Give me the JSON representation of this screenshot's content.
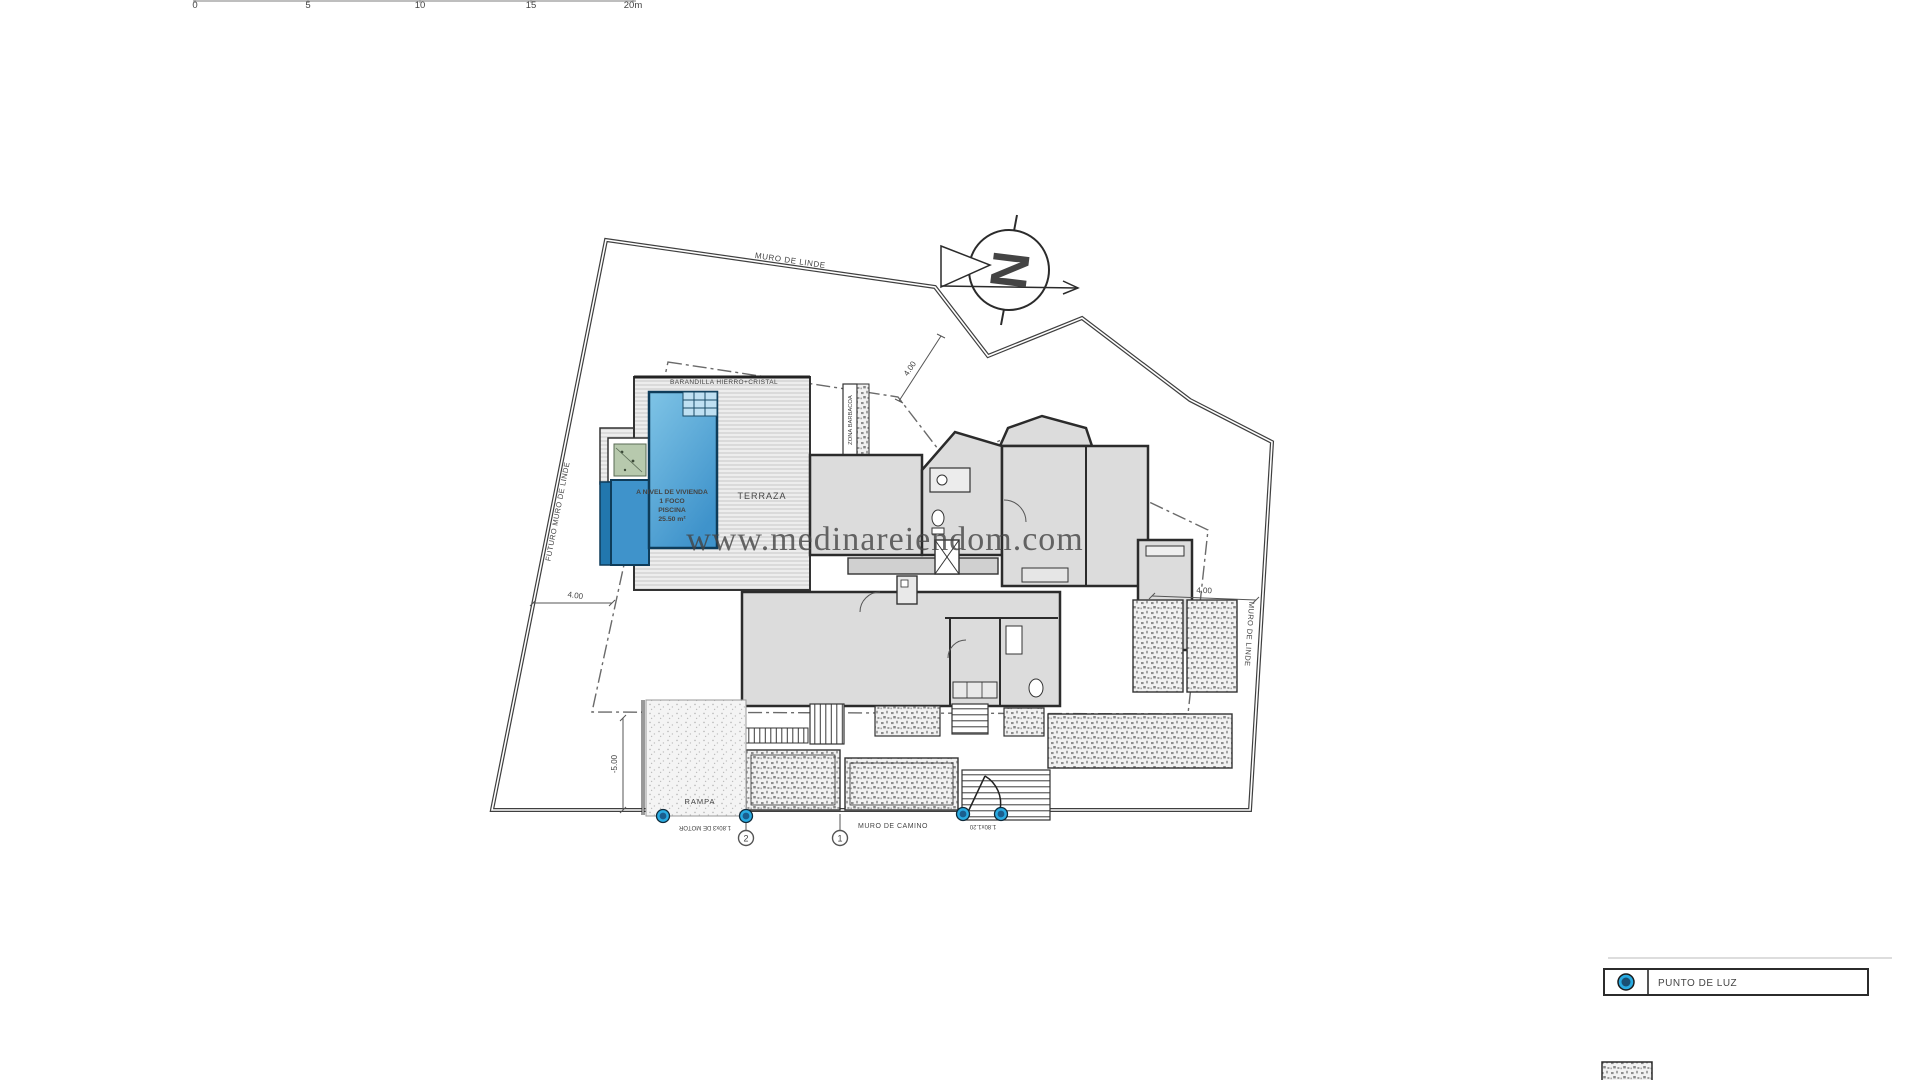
{
  "watermark": {
    "text": "www.medinareiendom.com"
  },
  "scale_bar": {
    "labels": [
      "0",
      "5",
      "10",
      "15",
      "20m"
    ]
  },
  "north": {
    "letter": "N"
  },
  "boundaries": {
    "top_wall": "MURO DE LINDE",
    "left_wall": "FUTURO MURO DE LINDE",
    "right_wall": "MURO DE LINDE",
    "bottom_wall": "MURO DE CAMINO"
  },
  "dimensions": {
    "left_setback": "4.00",
    "top_setback": "4.00",
    "right_setback": "4.00",
    "bottom_level": "-5.00"
  },
  "areas": {
    "terrace": "TERRAZA",
    "railing": "BARANDILLA HIERRO+CRISTAL",
    "bbq": "ZONA BARBACOA",
    "ramp": "RAMPA"
  },
  "pool": {
    "label_line1": "A NIVEL DE VIVIENDA",
    "label_line2": "1 FOCO",
    "label_line3": "PISCINA",
    "label_line4": "25.50 m²"
  },
  "gates": {
    "motor_gate": "1.80x3 DE MOTOR",
    "pedestrian_gate": "1.80x1.20",
    "marker_1": "1",
    "marker_2": "2"
  },
  "legend": {
    "light_point": "PUNTO DE LUZ"
  },
  "colors": {
    "pool_fill": "#4da0d6",
    "pool_dark": "#2277ae",
    "light_point_blue": "#29abe2",
    "planter_green": "#b7c9ad"
  }
}
